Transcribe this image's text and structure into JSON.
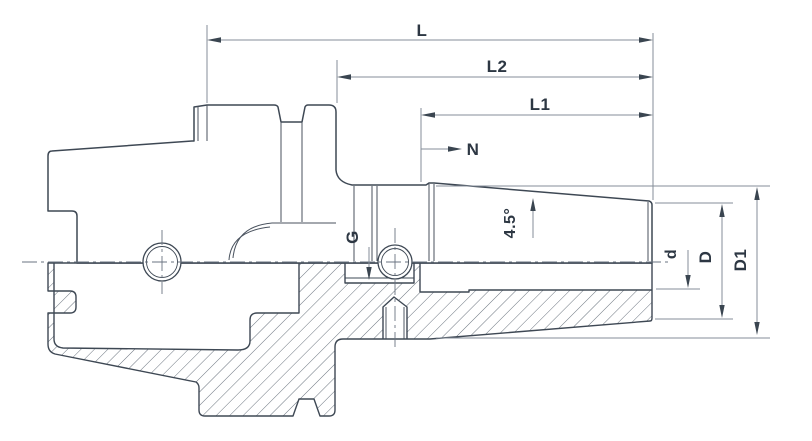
{
  "drawing": {
    "title": "tool-holder-section-drawing",
    "dimensions": {
      "overall_length": "L",
      "length_l2": "L2",
      "length_l1": "L1",
      "nose_marker": "N",
      "coolant_thread": "G",
      "taper_angle": "4.5°",
      "bore_diameter": "d",
      "nose_diameter": "D",
      "body_diameter": "D1"
    },
    "colors": {
      "background": "#ffffff",
      "outline": "#3e4854",
      "dimension_lines": "#848d98",
      "arrows": "#3a4550",
      "hatch": "#5a6470",
      "text": "#2d3743"
    }
  }
}
